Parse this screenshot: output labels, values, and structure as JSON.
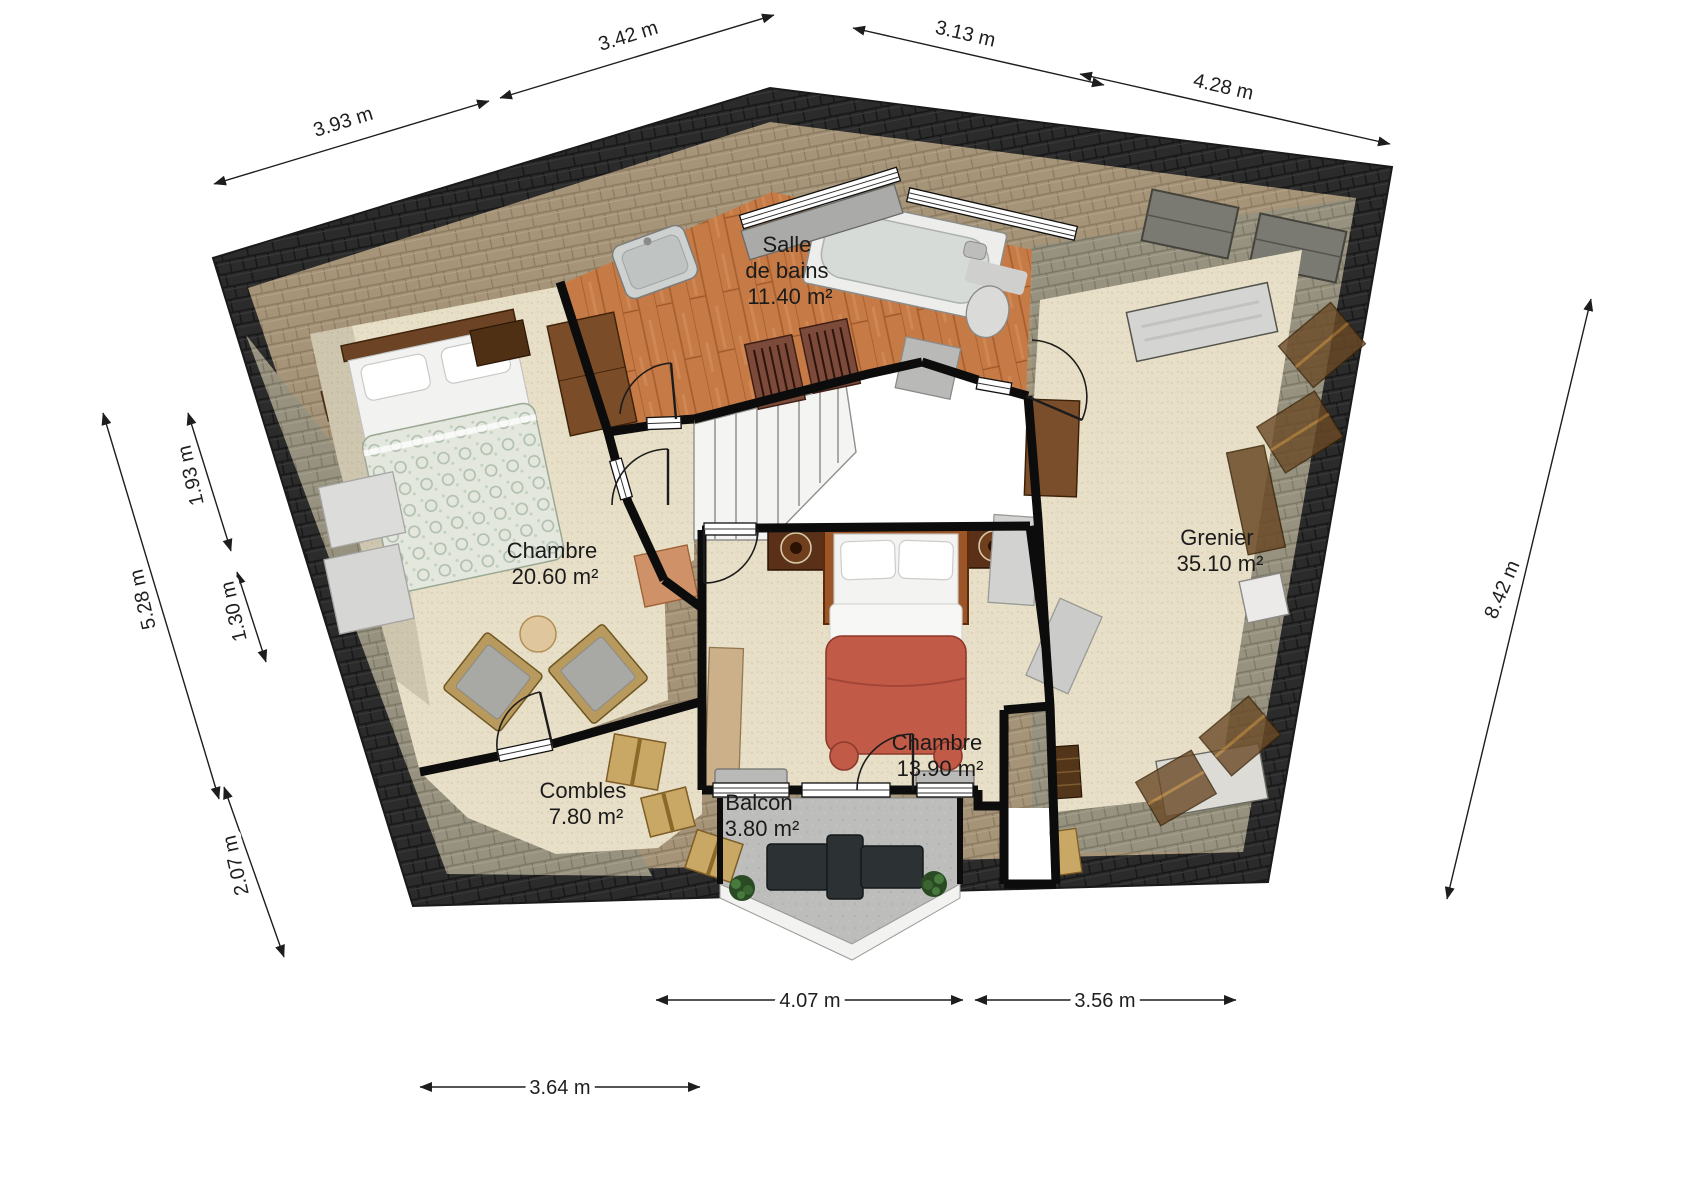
{
  "plan": {
    "kind": "residential floor plan (attic level)",
    "language": "French"
  },
  "rooms": [
    {
      "id": "salle-de-bains",
      "name": "Salle de bains",
      "lines": [
        "Salle",
        "de bains"
      ],
      "area": "11.40 m²"
    },
    {
      "id": "chambre-1",
      "name": "Chambre",
      "lines": [
        "Chambre"
      ],
      "area": "20.60 m²"
    },
    {
      "id": "combles",
      "name": "Combles",
      "lines": [
        "Combles"
      ],
      "area": "7.80 m²"
    },
    {
      "id": "chambre-2",
      "name": "Chambre",
      "lines": [
        "Chambre"
      ],
      "area": "13.90 m²"
    },
    {
      "id": "balcon",
      "name": "Balcon",
      "lines": [
        "Balcon"
      ],
      "area": "3.80 m²"
    },
    {
      "id": "grenier",
      "name": "Grenier",
      "lines": [
        "Grenier"
      ],
      "area": "35.10 m²"
    }
  ],
  "dimensions": {
    "top": [
      {
        "label": "3.93 m"
      },
      {
        "label": "3.42 m"
      },
      {
        "label": "3.13 m"
      },
      {
        "label": "4.28 m"
      }
    ],
    "left": [
      {
        "label": "1.93 m"
      },
      {
        "label": "1.30 m"
      },
      {
        "label": "5.28 m"
      },
      {
        "label": "2.07 m"
      }
    ],
    "right": [
      {
        "label": "8.42 m"
      }
    ],
    "bottom": [
      {
        "label": "4.07 m"
      },
      {
        "label": "3.56 m"
      },
      {
        "label": "3.64 m"
      }
    ]
  },
  "colors": {
    "roof_dark": "#2b2b2b",
    "roof_tan": "#a59478",
    "roof_gray": "#97927f",
    "floor_wood": "#c67a46",
    "floor_carpet": "#e8dfc8",
    "floor_concrete": "#bdbdbb",
    "bed_red": "#c25a48",
    "bed_paisley": "#e3e7dd",
    "wall": "#0c0c0c",
    "dimension_text": "#1f1f1f"
  }
}
